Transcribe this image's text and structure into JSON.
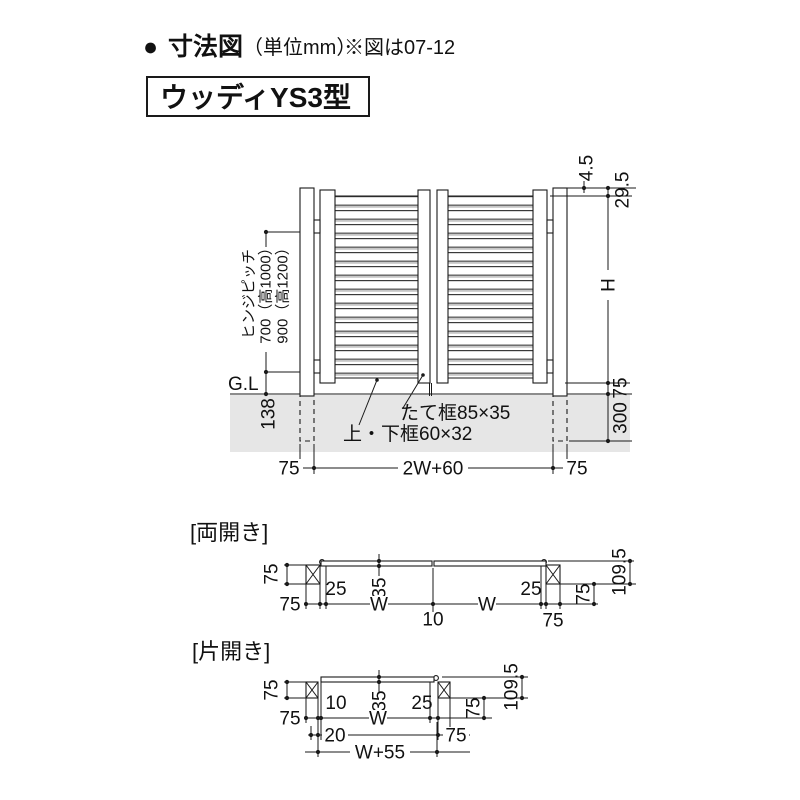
{
  "header": {
    "bullet": "●",
    "title": "寸法図",
    "unit": "（単位mm）",
    "note": "※図は07-12",
    "model": "ウッディYS3型"
  },
  "elevation": {
    "hinge_label": "ヒンジピッチ",
    "hinge_700": "700（高1000）",
    "hinge_900": "900（高1200）",
    "gl": "G.L",
    "d138": "138",
    "d45": "4.5",
    "d295": "29.5",
    "dH": "H",
    "d75r": "75",
    "d300": "300",
    "d75bl": "75",
    "d2w60": "2W+60",
    "d75br": "75",
    "tate": "たて框85×35",
    "joge": "上・下框60×32"
  },
  "ryobiraki": {
    "label": "[両開き]",
    "d75l": "75",
    "d75lb": "75",
    "d25l": "25",
    "d35": "35",
    "dWl": "W",
    "d10": "10",
    "dWr": "W",
    "d25r": "25",
    "d75rb": "75",
    "d75r": "75",
    "d1095": "109.5"
  },
  "katabiraki": {
    "label": "[片開き]",
    "d75l": "75",
    "d75lb": "75",
    "d10": "10",
    "d35": "35",
    "dW": "W",
    "d25": "25",
    "d20": "20",
    "d75rb": "75",
    "d75r": "75",
    "d1095": "109.5",
    "dw55": "W+55"
  },
  "colors": {
    "line": "#1a1a1a",
    "ground": "#e6e6e6"
  }
}
